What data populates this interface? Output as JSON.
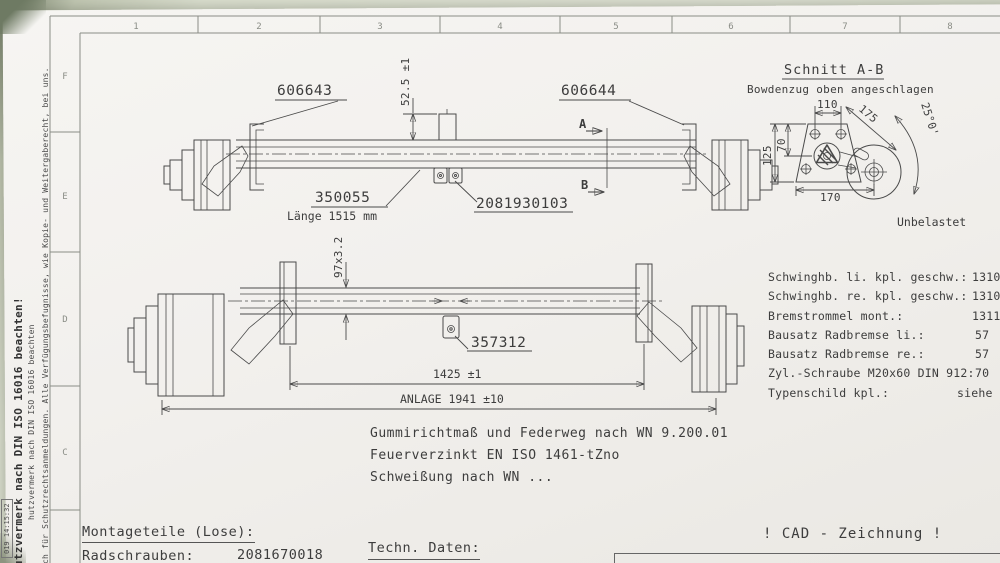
{
  "frame": {
    "columns": [
      "1",
      "2",
      "3",
      "4",
      "5",
      "6",
      "7",
      "8"
    ],
    "rows": [
      "F",
      "E",
      "D",
      "C"
    ]
  },
  "left_margin": {
    "stamp": "019 14:15:32",
    "protection_bold": "hutzvermerk nach DIN ISO 16016 beachten!",
    "protection_small": "hutzvermerk nach DIN ISO 16016 beachten",
    "protection_long": "auch für Schutzrechtsanmeldungen. Alle Verfügungsbefugnisse, wie Kopie- und Weitergaberecht, bei uns."
  },
  "drawing_top": {
    "part_left": "606643",
    "part_right": "606644",
    "part_axle": "350055",
    "axle_length": "Länge 1515 mm",
    "part_center": "2081930103",
    "dim_height": "52.5 ±1",
    "section_a": "A",
    "section_b": "B"
  },
  "drawing_bottom": {
    "dim_tube": "97x3.2",
    "part_bracket": "357312",
    "dim_span": "1425 ±1",
    "dim_total": "ANLAGE 1941 ±10"
  },
  "section_view": {
    "title": "Schnitt A-B",
    "subtitle": "Bowdenzug oben angeschlagen",
    "dim_width_top": "110",
    "dim_diag": "175",
    "dim_height": "125",
    "dim_height_inner": "70",
    "dim_width_bottom": "170",
    "dim_angle": "25°0'",
    "caption": "Unbelastet"
  },
  "notes": {
    "line1": "Gummirichtmaß und Federweg nach WN 9.200.01",
    "line2": "Feuerverzinkt EN ISO 1461-tZno",
    "line3": "Schweißung nach WN ..."
  },
  "parts_list": {
    "rows": [
      {
        "label": "Schwinghb. li. kpl. geschw.:",
        "value": "1310"
      },
      {
        "label": "Schwinghb. re. kpl. geschw.:",
        "value": "1310"
      },
      {
        "label": "Bremstrommel mont.:",
        "value": "1311"
      },
      {
        "label": "Bausatz Radbremse li.:",
        "value": "57"
      },
      {
        "label": "Bausatz Radbremse re.:",
        "value": "57"
      },
      {
        "label": "Zyl.-Schraube M20x60 DIN 912:",
        "value": "70"
      },
      {
        "label": "Typenschild kpl.:",
        "value": "siehe"
      }
    ]
  },
  "footer": {
    "montageteile": "Montageteile (Lose):",
    "radschrauben_label": "Radschrauben:",
    "radschrauben_value": "2081670018",
    "techn_daten": "Techn. Daten:",
    "cad": "! CAD - Zeichnung !"
  },
  "colors": {
    "ink": "#4a4a4a",
    "paper": "#f2f0ed",
    "background": "#dde1d1"
  }
}
